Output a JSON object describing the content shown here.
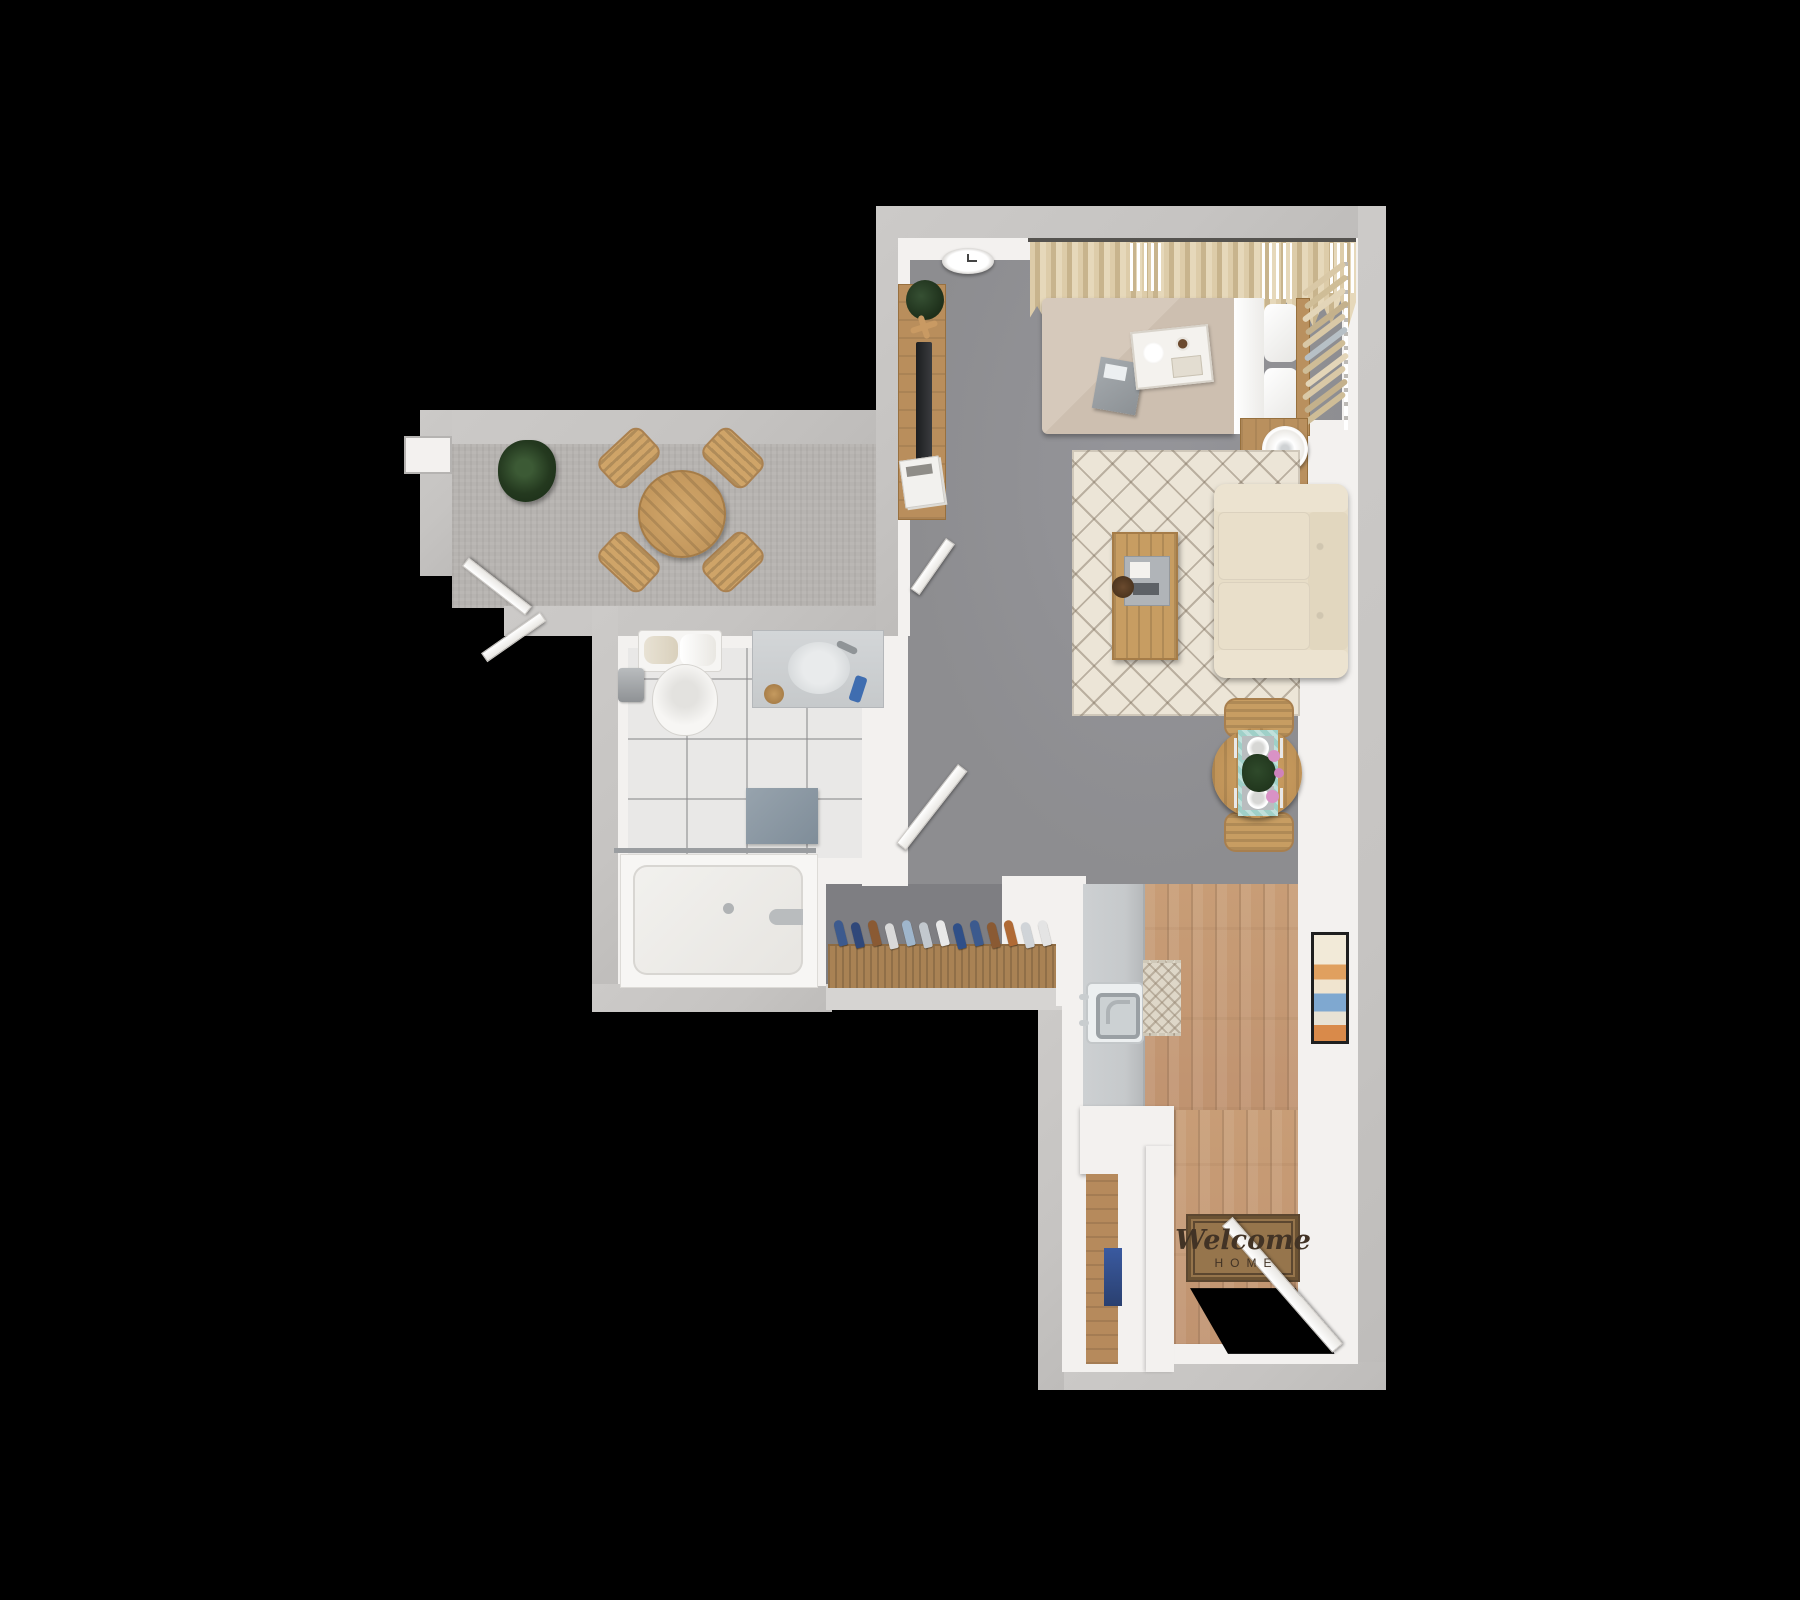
{
  "doormat": {
    "line1": "Welcome",
    "line2": "HOME"
  },
  "palette": {
    "wall-outer": "#c6c4c2",
    "wall-inner": "#f3f1ef",
    "floor-main": "#8d8d90",
    "floor-alcove": "#7e7e82",
    "floor-balcony": "#b6b3b0",
    "floor-tile": "#e9e8e7",
    "floor-wood": "#c09370",
    "rug-cream": "#ece5d7",
    "sofa-cream": "#e7ddc7",
    "wood-furniture": "#c79d62",
    "runner-teal": "#9fd0c8",
    "mat-brown": "#96754c",
    "bed-duvet": "#cdbfb0",
    "counter-gray": "#c6c9cb",
    "shoe-navy": "#3c5a8e"
  },
  "rooms": [
    {
      "name": "balcony",
      "items": [
        "potted-plant",
        "round-patio-table",
        "patio-chair",
        "patio-chair",
        "patio-chair",
        "patio-chair"
      ]
    },
    {
      "name": "bathroom",
      "items": [
        "toilet",
        "toilet-paper-holder",
        "vanity-sink",
        "bath-mat",
        "bathtub",
        "shower-rod"
      ]
    },
    {
      "name": "bedroom-living",
      "items": [
        "wall-clock",
        "curtains",
        "vertical-blinds",
        "tv-console",
        "tv",
        "plant",
        "magazines",
        "bed",
        "breakfast-tray",
        "speaker-cube",
        "hanging-clothes-rack",
        "nightstand",
        "lamp",
        "area-rug",
        "sofa",
        "coffee-table",
        "dining-table",
        "dining-chair",
        "dining-chair"
      ]
    },
    {
      "name": "entry-kitchen",
      "items": [
        "shoe-rack",
        "kitchen-counter",
        "kitchen-sink",
        "pantry-closet",
        "runner-rug",
        "wall-art",
        "welcome-doormat",
        "entry-door"
      ]
    }
  ]
}
